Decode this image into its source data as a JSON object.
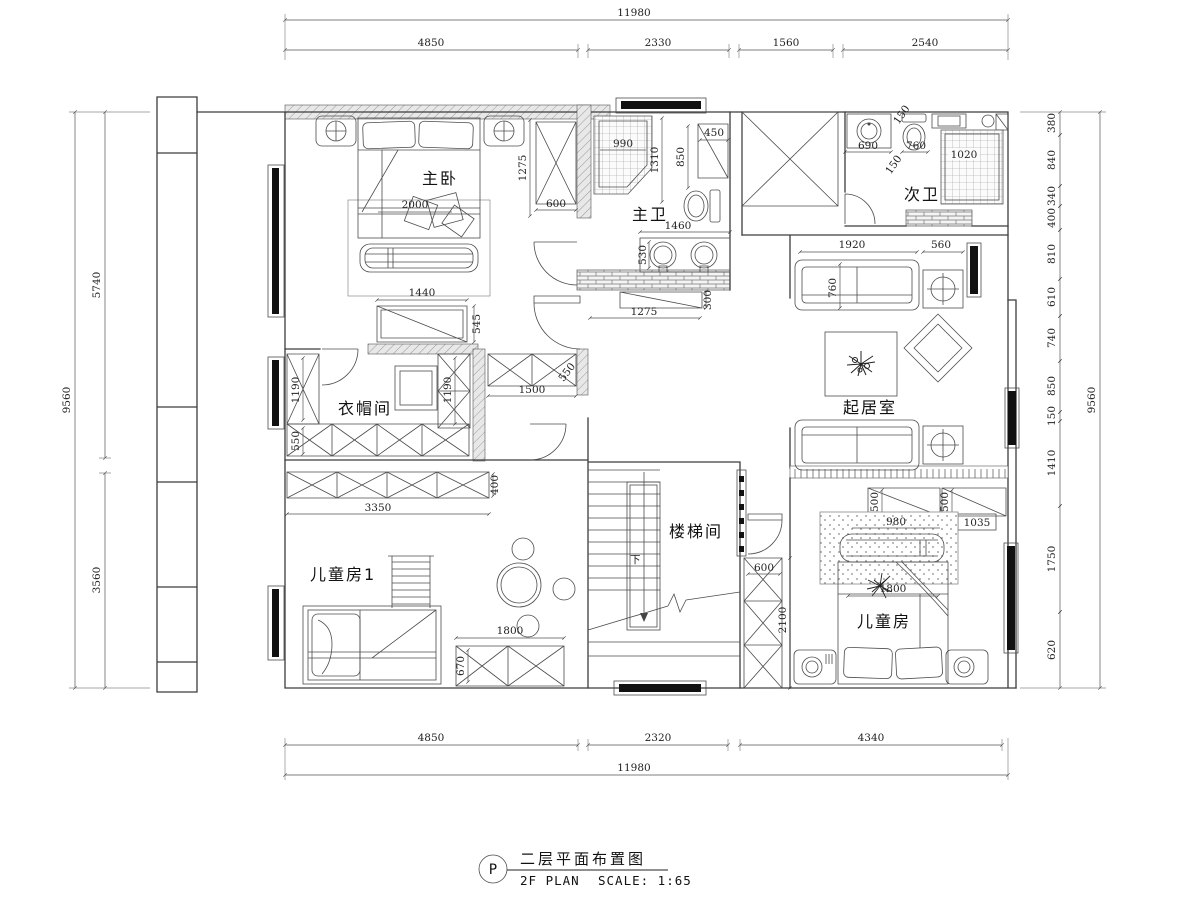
{
  "title_block": {
    "bubble": "P",
    "title_cn": "二层平面布置图",
    "title_en": "2F PLAN",
    "scale": "SCALE: 1:65"
  },
  "rooms": {
    "master_bedroom": "主卧",
    "master_bath": "主卫",
    "second_bath": "次卫",
    "cloakroom": "衣帽间",
    "living_room": "起居室",
    "stairwell": "楼梯间",
    "kids_room_1": "儿童房1",
    "kids_room_2": "儿童房",
    "stair_down": "下"
  },
  "colors": {
    "line": "#3c3c3c",
    "wall_hatch_fill": "#e8e8e8",
    "window_bar": "#111111",
    "background": "#ffffff"
  },
  "dims": {
    "top_total": "11980",
    "top_segments": [
      "4850",
      "2330",
      "1560",
      "2540"
    ],
    "bottom_total": "11980",
    "bottom_segments": [
      "4850",
      "2320",
      "4340"
    ],
    "left_total": "9560",
    "left_segments": [
      "5740",
      "3560"
    ],
    "right_total": "9560",
    "right_segments": [
      "380",
      "840",
      "340",
      "400",
      "810",
      "610",
      "740",
      "850",
      "150",
      "1410",
      "1750",
      "620"
    ],
    "interior": {
      "m2000": "2000",
      "m1440": "1440",
      "m1275": "1275",
      "m600": "600",
      "m545": "545",
      "b990": "990",
      "b1310": "1310",
      "b850": "850",
      "b450": "450",
      "b1460": "1460",
      "b530": "530",
      "b1275": "1275",
      "b300": "300",
      "s690": "690",
      "s760": "760",
      "s1020": "1020",
      "s150a": "150",
      "s150b": "150",
      "l1920": "1920",
      "l560": "560",
      "l760": "760",
      "c1190a": "1190",
      "c1190b": "1190",
      "c550a": "550",
      "c550b": "550",
      "c1500": "1500",
      "c400": "400",
      "c3350": "3350",
      "st600": "600",
      "st2100": "2100",
      "k500a": "500",
      "k500b": "500",
      "k980": "980",
      "k1035": "1035",
      "k1800": "1800",
      "k1_1800": "1800",
      "k1_670": "670"
    }
  }
}
